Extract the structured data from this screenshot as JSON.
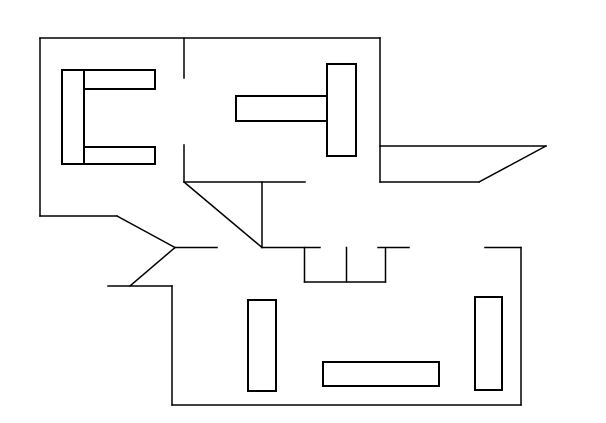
{
  "drawing": {
    "title": "floor-plan-sketch",
    "canvas": {
      "width": 606,
      "height": 423,
      "background_color": "#ffffff",
      "line_color": "#000000",
      "wall_line_width": 1.5,
      "furniture_line_width": 2
    },
    "walls": [
      {
        "name": "top-wall",
        "x1": 40,
        "y1": 38,
        "x2": 380,
        "y2": 38
      },
      {
        "name": "left-wall",
        "x1": 40,
        "y1": 38,
        "x2": 40,
        "y2": 216
      },
      {
        "name": "left-lower-wall",
        "x1": 40,
        "y1": 216,
        "x2": 117,
        "y2": 216
      },
      {
        "name": "entry-diagonal-upper",
        "x1": 117,
        "y1": 216,
        "x2": 175,
        "y2": 247.5
      },
      {
        "name": "entry-top-wall",
        "x1": 175,
        "y1": 247.5,
        "x2": 217,
        "y2": 247.5
      },
      {
        "name": "entry-diagonal-lower",
        "x1": 175,
        "y1": 247.5,
        "x2": 130,
        "y2": 286
      },
      {
        "name": "entry-stub-wall",
        "x1": 108,
        "y1": 286,
        "x2": 172,
        "y2": 286
      },
      {
        "name": "lower-left-wall",
        "x1": 172,
        "y1": 286,
        "x2": 172,
        "y2": 405
      },
      {
        "name": "bottom-wall",
        "x1": 172,
        "y1": 405,
        "x2": 521,
        "y2": 405
      },
      {
        "name": "lower-right-wall",
        "x1": 521,
        "y1": 247.5,
        "x2": 521,
        "y2": 405
      },
      {
        "name": "lower-room-top-right-wall",
        "x1": 485,
        "y1": 247.5,
        "x2": 521,
        "y2": 247.5
      },
      {
        "name": "upper-right-wall",
        "x1": 380,
        "y1": 38,
        "x2": 380,
        "y2": 182
      },
      {
        "name": "terrace-top-edge",
        "x1": 380,
        "y1": 146,
        "x2": 546,
        "y2": 146
      },
      {
        "name": "terrace-bottom-edge",
        "x1": 380,
        "y1": 182,
        "x2": 479,
        "y2": 182
      },
      {
        "name": "terrace-diagonal-edge",
        "x1": 479,
        "y1": 182,
        "x2": 546,
        "y2": 146
      },
      {
        "name": "room-divider-upper",
        "x1": 184,
        "y1": 38,
        "x2": 184,
        "y2": 78
      },
      {
        "name": "room-divider-lower",
        "x1": 184,
        "y1": 145,
        "x2": 184,
        "y2": 182
      },
      {
        "name": "hall-top-wall",
        "x1": 184,
        "y1": 182,
        "x2": 305,
        "y2": 182
      },
      {
        "name": "stair-diagonal",
        "x1": 184,
        "y1": 182,
        "x2": 262,
        "y2": 247.5
      },
      {
        "name": "stair-right-wall",
        "x1": 262,
        "y1": 182,
        "x2": 262,
        "y2": 247.5
      },
      {
        "name": "hall-bottom-wall-left",
        "x1": 262,
        "y1": 247.5,
        "x2": 320,
        "y2": 247.5
      },
      {
        "name": "hall-bottom-wall-right",
        "x1": 378,
        "y1": 247.5,
        "x2": 409,
        "y2": 247.5
      },
      {
        "name": "closet-left-side",
        "x1": 304.5,
        "y1": 247.5,
        "x2": 304.5,
        "y2": 282
      },
      {
        "name": "closet-divider",
        "x1": 346.5,
        "y1": 247.5,
        "x2": 346.5,
        "y2": 282
      },
      {
        "name": "closet-right-side",
        "x1": 385.5,
        "y1": 248,
        "x2": 385.5,
        "y2": 282
      },
      {
        "name": "closet-bottom",
        "x1": 304.5,
        "y1": 282,
        "x2": 385.5,
        "y2": 282
      }
    ],
    "furniture": [
      {
        "name": "sofa-back-upper-left-room",
        "x": 62,
        "y": 70,
        "w": 22,
        "h": 94
      },
      {
        "name": "sofa-arm-top",
        "x": 84,
        "y": 70,
        "w": 71,
        "h": 19
      },
      {
        "name": "sofa-arm-bottom",
        "x": 84,
        "y": 147,
        "w": 71,
        "h": 17
      },
      {
        "name": "table-middle-room",
        "x": 236,
        "y": 96,
        "w": 91,
        "h": 25
      },
      {
        "name": "cabinet-middle-room",
        "x": 327,
        "y": 64,
        "w": 29,
        "h": 92
      },
      {
        "name": "shelf-lower-left",
        "x": 248,
        "y": 300,
        "w": 28,
        "h": 91
      },
      {
        "name": "table-lower-room",
        "x": 323,
        "y": 362,
        "w": 116,
        "h": 24
      },
      {
        "name": "cabinet-lower-right",
        "x": 475,
        "y": 297,
        "w": 27,
        "h": 93
      }
    ]
  }
}
